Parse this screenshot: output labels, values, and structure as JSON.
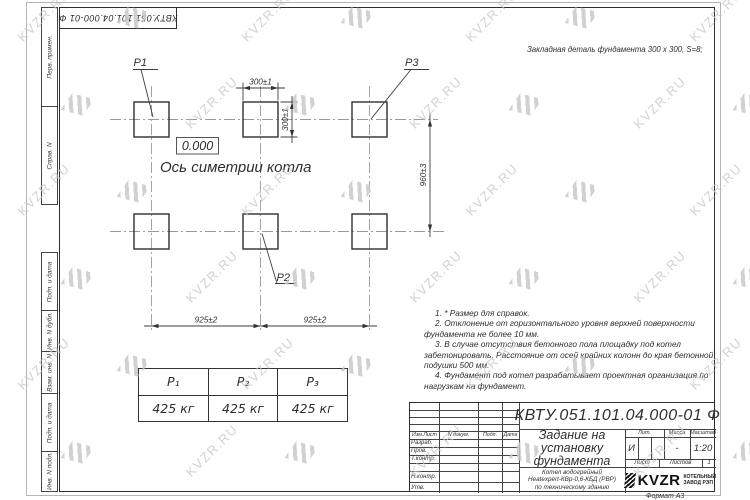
{
  "stamp_top_left": "КВТУ.051.101.04.000-01  Ф",
  "side_labels": {
    "top": [
      "Перв. примен.",
      "Справ. N"
    ],
    "bottom": [
      "Подп. и дата",
      "Инв. N дубл.",
      "Взам. инв. N",
      "Подп. и дата",
      "Инв. N подл."
    ]
  },
  "drawing": {
    "pad_labels": {
      "p1": "P1",
      "p2": "P2",
      "p3": "P3"
    },
    "elevation": "0.000",
    "axis_label": "Ось симетрии котла",
    "embed_note": "Закладная деталь фундамента  300 х 300,  S=8;",
    "dims": {
      "width_top": "300±1",
      "height_side": "300±1",
      "row_spacing": "960±3",
      "col_spacing_left": "925±2",
      "col_spacing_right": "925±2"
    }
  },
  "notes": [
    "1. * Размер для справок.",
    "2. Отклонение от горизонтального уровня верхней поверхности фундамента не более 10 мм.",
    "3. В случае отсутствия бетонного пола площадку под котел забетонировать. Расстояние от осей крайних колонн до края бетонной подушки 500 мм.",
    "4. Фундамент под котел разрабатывает проектная организация по нагрузкам на фундамент."
  ],
  "load_table": {
    "headers": [
      "P₁",
      "P₂",
      "P₃"
    ],
    "values": [
      "425 кг",
      "425 кг",
      "425 кг"
    ]
  },
  "title_block": {
    "designation": "КВТУ.051.101.04.000-01  Ф",
    "title_lines": [
      "Задание на",
      "установку",
      "фундамента"
    ],
    "product_lines": [
      "Котел водогрейный",
      "Heatexpert-КВр-0,6-КБД (РВР)",
      "по техническому зданию"
    ],
    "col_headers": [
      "Изм.Лист",
      "N докум.",
      "Подп.",
      "Дата"
    ],
    "row_labels": [
      "Разраб.",
      "Пров.",
      "Т.контр.",
      "Н.контр.",
      "Утв."
    ],
    "lit_header": "Лит.",
    "mass_header": "Масса",
    "scale_header": "Масштаб",
    "lit_value": "И",
    "mass_value": "-",
    "scale_value": "1:20",
    "sheet_label": "Лист",
    "sheets_label": "Листов",
    "sheets_value": "1",
    "logo_text": "KVZR",
    "logo_sub1": "КОТЕЛЬНЫЙ",
    "logo_sub2": "ЗАВОД РЭП",
    "format": "Формат А3"
  },
  "watermark": {
    "text": "KVZR.RU"
  }
}
